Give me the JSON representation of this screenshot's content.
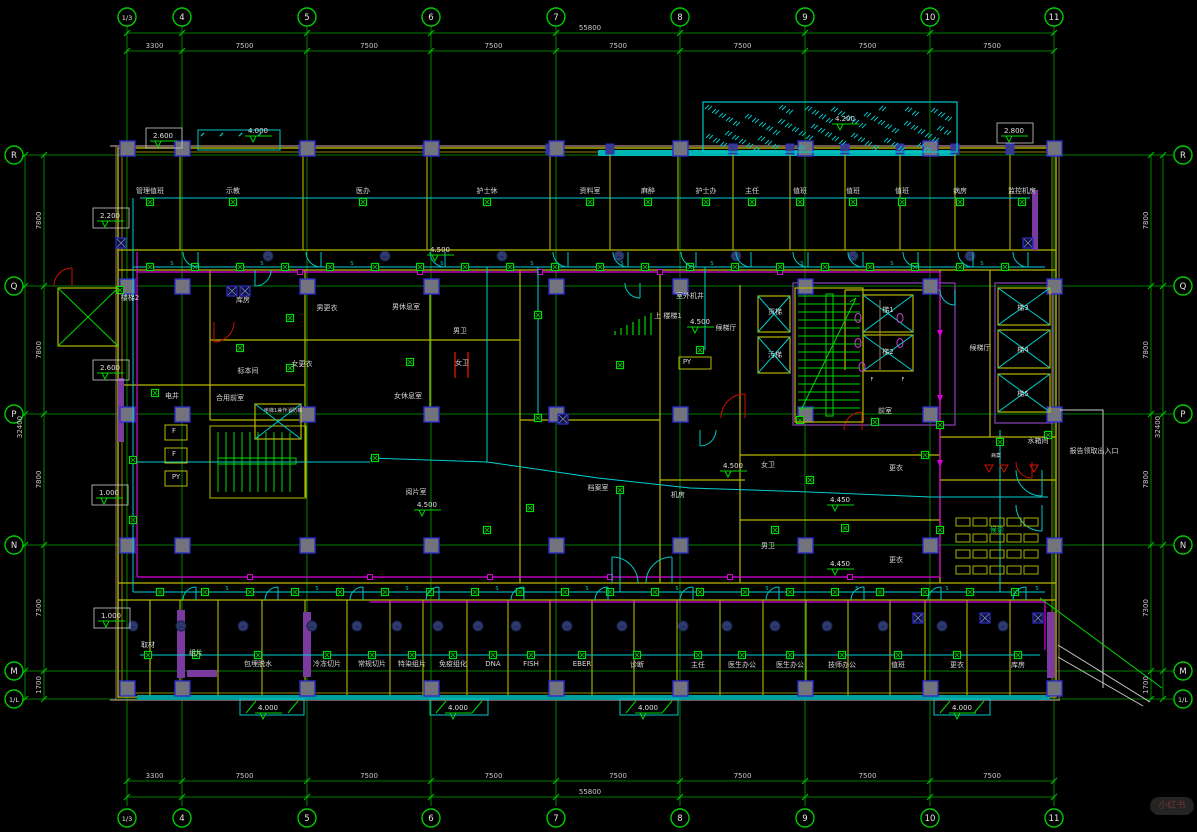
{
  "watermark": {
    "label": "小红书"
  },
  "grid": {
    "cols": {
      "bubbles": [
        "1/3",
        "4",
        "5",
        "6",
        "7",
        "8",
        "9",
        "10",
        "11"
      ],
      "x": [
        127,
        182,
        307,
        431,
        556,
        680,
        805,
        930,
        1054
      ],
      "dims": [
        "3300",
        "7500",
        "7500",
        "7500",
        "7500",
        "7500",
        "7500",
        "7500"
      ],
      "overall": "55800"
    },
    "rows": {
      "bubbles": [
        "R",
        "Q",
        "P",
        "N",
        "M",
        "1/L"
      ],
      "y": [
        155,
        286,
        414,
        545,
        671,
        699
      ],
      "dims": [
        "7800",
        "7800",
        "7800",
        "7300",
        "1700"
      ],
      "overall": "32400"
    }
  },
  "rooms_top": [
    {
      "x": 150,
      "label": "管理值班"
    },
    {
      "x": 233,
      "label": "示教"
    },
    {
      "x": 363,
      "label": "医办"
    },
    {
      "x": 487,
      "label": "护士休"
    },
    {
      "x": 590,
      "label": "资料室"
    },
    {
      "x": 648,
      "label": "麻醉"
    },
    {
      "x": 706,
      "label": "护士办"
    },
    {
      "x": 752,
      "label": "主任"
    },
    {
      "x": 800,
      "label": "值班"
    },
    {
      "x": 853,
      "label": "值班"
    },
    {
      "x": 902,
      "label": "值班"
    },
    {
      "x": 960,
      "label": "病房"
    },
    {
      "x": 1022,
      "label": "监控机房"
    }
  ],
  "rooms_bottom": [
    {
      "x": 148,
      "y": 647,
      "label": "取材"
    },
    {
      "x": 196,
      "y": 655,
      "label": "组片"
    },
    {
      "x": 258,
      "y": 666,
      "label": "包埋脱水"
    },
    {
      "x": 327,
      "y": 666,
      "label": "冷冻切片"
    },
    {
      "x": 372,
      "y": 666,
      "label": "常规切片"
    },
    {
      "x": 412,
      "y": 666,
      "label": "特染组片"
    },
    {
      "x": 453,
      "y": 666,
      "label": "免疫组化"
    },
    {
      "x": 493,
      "y": 666,
      "label": "DNA"
    },
    {
      "x": 531,
      "y": 666,
      "label": "FISH"
    },
    {
      "x": 582,
      "y": 666,
      "label": "EBER"
    },
    {
      "x": 637,
      "y": 667,
      "label": "诊断"
    },
    {
      "x": 698,
      "y": 667,
      "label": "主任"
    },
    {
      "x": 742,
      "y": 667,
      "label": "医生办公"
    },
    {
      "x": 790,
      "y": 667,
      "label": "医生办公"
    },
    {
      "x": 842,
      "y": 667,
      "label": "技师办公"
    },
    {
      "x": 898,
      "y": 667,
      "label": "值班"
    },
    {
      "x": 957,
      "y": 667,
      "label": "更衣"
    },
    {
      "x": 1018,
      "y": 667,
      "label": "库房"
    }
  ],
  "labels_mid": [
    {
      "t": "楼梯2",
      "x": 130,
      "y": 300
    },
    {
      "t": "库房",
      "x": 243,
      "y": 302
    },
    {
      "t": "男更衣",
      "x": 327,
      "y": 310
    },
    {
      "t": "男休息室",
      "x": 406,
      "y": 309
    },
    {
      "t": "男卫",
      "x": 460,
      "y": 333
    },
    {
      "t": "女卫",
      "x": 462,
      "y": 365
    },
    {
      "t": "女更衣",
      "x": 302,
      "y": 366
    },
    {
      "t": "女休息室",
      "x": 408,
      "y": 398
    },
    {
      "t": "标本间",
      "x": 248,
      "y": 373
    },
    {
      "t": "电井",
      "x": 172,
      "y": 398
    },
    {
      "t": "合用前室",
      "x": 230,
      "y": 400
    },
    {
      "t": "电梯1兼作消防梯",
      "x": 283,
      "y": 412,
      "s": 5
    },
    {
      "t": "F",
      "x": 174,
      "y": 433
    },
    {
      "t": "F",
      "x": 174,
      "y": 456
    },
    {
      "t": "PY",
      "x": 176,
      "y": 479
    },
    {
      "t": "室外机井",
      "x": 690,
      "y": 298
    },
    {
      "t": "上 楼梯1",
      "x": 668,
      "y": 318
    },
    {
      "t": "候梯厅",
      "x": 726,
      "y": 330
    },
    {
      "t": "PY",
      "x": 687,
      "y": 364
    },
    {
      "t": "货梯",
      "x": 775,
      "y": 314
    },
    {
      "t": "污梯",
      "x": 775,
      "y": 357
    },
    {
      "t": "梯1",
      "x": 888,
      "y": 312
    },
    {
      "t": "梯2",
      "x": 888,
      "y": 354
    },
    {
      "t": "F",
      "x": 872,
      "y": 381,
      "s": 5
    },
    {
      "t": "F",
      "x": 903,
      "y": 381,
      "s": 5
    },
    {
      "t": "前室",
      "x": 885,
      "y": 413
    },
    {
      "t": "候梯厅",
      "x": 980,
      "y": 350
    },
    {
      "t": "梯3",
      "x": 1023,
      "y": 310
    },
    {
      "t": "梯4",
      "x": 1023,
      "y": 352
    },
    {
      "t": "梯5",
      "x": 1023,
      "y": 396
    },
    {
      "t": "阅片室",
      "x": 416,
      "y": 494
    },
    {
      "t": "档案室",
      "x": 598,
      "y": 490
    },
    {
      "t": "机房",
      "x": 678,
      "y": 497
    },
    {
      "t": "女卫",
      "x": 768,
      "y": 467
    },
    {
      "t": "更衣",
      "x": 896,
      "y": 470
    },
    {
      "t": "男卫",
      "x": 768,
      "y": 548
    },
    {
      "t": "更衣",
      "x": 896,
      "y": 562
    },
    {
      "t": "候诊",
      "x": 997,
      "y": 532,
      "c": "#00cc44"
    },
    {
      "t": "水箱间",
      "x": 1038,
      "y": 443
    },
    {
      "t": "报告领取出入口",
      "x": 1094,
      "y": 453
    },
    {
      "t": "病案",
      "x": 996,
      "y": 457,
      "s": 5
    }
  ],
  "elevations": [
    {
      "v": "2.600",
      "x": 163,
      "y": 138,
      "box": true
    },
    {
      "v": "4.000",
      "x": 258,
      "y": 133
    },
    {
      "v": "4.200",
      "x": 845,
      "y": 121
    },
    {
      "v": "2.800",
      "x": 1014,
      "y": 133,
      "box": true
    },
    {
      "v": "2.200",
      "x": 110,
      "y": 218,
      "box": true
    },
    {
      "v": "2.600",
      "x": 110,
      "y": 370,
      "box": true
    },
    {
      "v": "1.000",
      "x": 109,
      "y": 495,
      "box": true
    },
    {
      "v": "1.000",
      "x": 111,
      "y": 618,
      "box": true
    },
    {
      "v": "4.500",
      "x": 440,
      "y": 252
    },
    {
      "v": "4.500",
      "x": 700,
      "y": 324
    },
    {
      "v": "4.500",
      "x": 427,
      "y": 507
    },
    {
      "v": "4.500",
      "x": 733,
      "y": 468
    },
    {
      "v": "4.450",
      "x": 840,
      "y": 502
    },
    {
      "v": "4.450",
      "x": 840,
      "y": 566
    },
    {
      "v": "4.000",
      "x": 268,
      "y": 710
    },
    {
      "v": "4.000",
      "x": 458,
      "y": 710
    },
    {
      "v": "4.000",
      "x": 648,
      "y": 710
    },
    {
      "v": "4.000",
      "x": 962,
      "y": 710
    }
  ],
  "switch_letter": "S",
  "colors": {
    "grid": "#00a400",
    "bubble": "#00cc00",
    "dimtext": "#c8c8c8",
    "wall": "#b8b800",
    "wall2": "#8a8a00",
    "edge": "#96756a",
    "accent": "#7a3aa0",
    "circuit": "#00d0d0",
    "cable": "#dd00dd",
    "device": "#00dd00",
    "stair": "#00d800",
    "door": "#00c8c8",
    "alarm": "#cc1100",
    "column_fill": "#73737e",
    "column_stroke": "#2d2dc8",
    "label": "#d8d8d8",
    "hatch": "#00c8c8",
    "ceil_fill": "#2e3a6e",
    "chair": "#a8b400"
  }
}
